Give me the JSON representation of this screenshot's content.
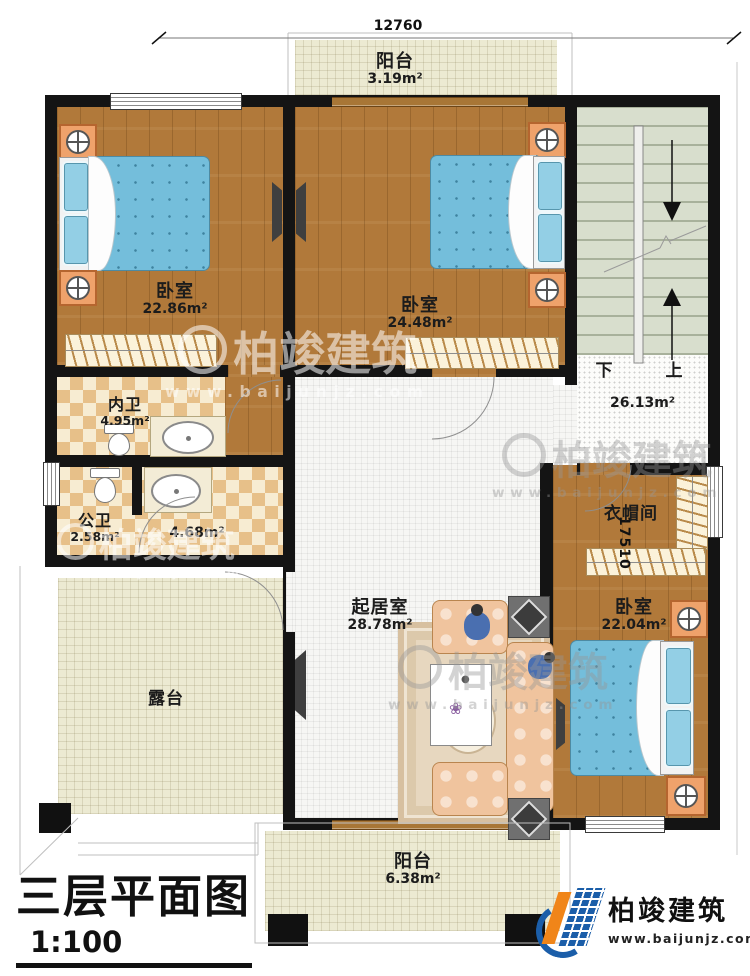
{
  "dimensions": {
    "top": "12760",
    "right": "17510"
  },
  "watermark": {
    "brand": "柏竣建筑",
    "url": "www.baijunjz.com"
  },
  "rooms": {
    "balcony_top": {
      "name": "阳台",
      "area": "3.19m²"
    },
    "bedroom1": {
      "name": "卧室",
      "area": "22.86m²"
    },
    "bedroom2": {
      "name": "卧室",
      "area": "24.48m²"
    },
    "stair_hall": {
      "area": "26.13m²",
      "down_label": "下",
      "up_label": "上"
    },
    "bath_inner": {
      "name": "内卫",
      "area": "4.95m²"
    },
    "bath_public": {
      "name": "公卫",
      "area": "2.58m²"
    },
    "hallway": {
      "area": "4.68m²"
    },
    "living": {
      "name": "起居室",
      "area": "28.78m²"
    },
    "cloakroom": {
      "name": "衣帽间"
    },
    "bedroom3": {
      "name": "卧室",
      "area": "22.04m²"
    },
    "terrace": {
      "name": "露台"
    },
    "balcony_bottom": {
      "name": "阳台",
      "area": "6.38m²"
    }
  },
  "title_block": {
    "title": "三层平面图",
    "scale": "1:100",
    "floor_area": "本层建筑面积: 159.60m²",
    "floor_height": "层高: 3.3m"
  },
  "logo": {
    "brand": "柏竣建筑",
    "url": "www.baijunjz.com"
  },
  "colors": {
    "wall": "#141414",
    "wood": "#b1793a",
    "bed_blue": "#74bedb",
    "tile_cream": "#ecead2",
    "stair_green": "#d8decd",
    "logo_blue": "#1b5ea9",
    "logo_orange": "#f08519"
  }
}
